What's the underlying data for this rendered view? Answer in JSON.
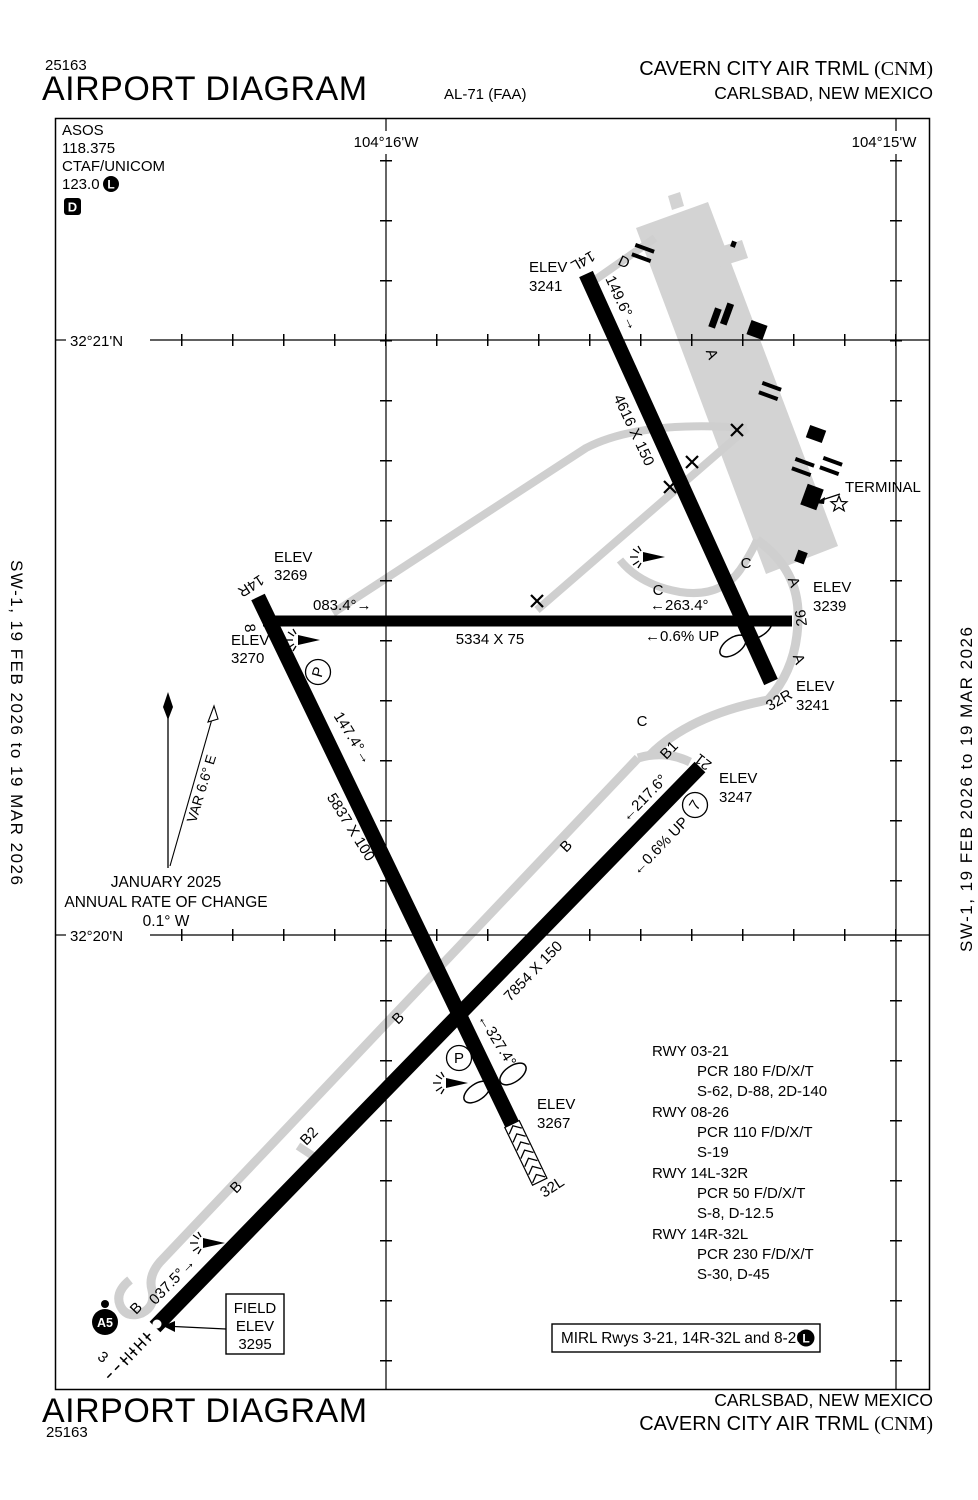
{
  "header": {
    "chart_number": "25163",
    "title": "AIRPORT DIAGRAM",
    "plate_id": "AL-71 (FAA)",
    "airport_name": "CAVERN CITY AIR TRML",
    "airport_code": "(CNM)",
    "city": "CARLSBAD, NEW MEXICO"
  },
  "footer": {
    "chart_number": "25163",
    "title": "AIRPORT DIAGRAM",
    "airport_name": "CAVERN CITY AIR TRML",
    "airport_code": "(CNM)",
    "city": "CARLSBAD, NEW MEXICO"
  },
  "margin_note": "SW-1,  19 FEB 2026  to  19 MAR 2026",
  "comm": {
    "asos_label": "ASOS",
    "asos_freq": "118.375",
    "ctaf_label": "CTAF/UNICOM",
    "ctaf_freq": "123.0",
    "lighting_badge": "L",
    "weather_badge": "D"
  },
  "grid": {
    "lon_west": "104°16'W",
    "lon_east": "104°15'W",
    "lat_north": "32°21'N",
    "lat_south": "32°20'N"
  },
  "magnetic": {
    "month": "JANUARY 2025",
    "note": "ANNUAL RATE OF CHANGE",
    "rate": "0.1° W",
    "variation": "VAR 6.6° E"
  },
  "terminal_label": "TERMINAL",
  "field_elevation": {
    "line1": "FIELD",
    "line2": "ELEV",
    "line3": "3295"
  },
  "mirl": {
    "text": "MIRL Rwys 3-21, 14R-32L and 8-26",
    "badge": "L"
  },
  "rwy_data": [
    {
      "rwy": "RWY 03-21",
      "pcr": "PCR 180 F/D/X/T",
      "strength": "S-62, D-88, 2D-140"
    },
    {
      "rwy": "RWY 08-26",
      "pcr": "PCR 110 F/D/X/T",
      "strength": "S-19"
    },
    {
      "rwy": "RWY 14L-32R",
      "pcr": "PCR 50 F/D/X/T",
      "strength": "S-8, D-12.5"
    },
    {
      "rwy": "RWY 14R-32L",
      "pcr": "PCR 230 F/D/X/T",
      "strength": "S-30, D-45"
    }
  ],
  "runways": {
    "r14l": {
      "end": "14L",
      "elev_label": "ELEV",
      "elev": "3241",
      "heading": "149.6°→",
      "dims": "4616 X 150"
    },
    "r32r": {
      "end": "32R",
      "elev_label": "ELEV",
      "elev": "3241"
    },
    "r8": {
      "end": "8",
      "elev_label": "ELEV",
      "elev": "3270",
      "heading": "083.4°→",
      "dims": "5334 X 75"
    },
    "r26": {
      "end": "26",
      "elev_label": "ELEV",
      "elev": "3239",
      "heading": "←263.4°",
      "slope": "←0.6% UP"
    },
    "r14r": {
      "end": "14R",
      "elev_label": "ELEV",
      "elev": "3269",
      "heading": "147.4°→",
      "dims": "5837 X 100"
    },
    "r32l": {
      "end": "32L",
      "elev_label": "ELEV",
      "elev": "3267",
      "heading": "←327.4°"
    },
    "r3": {
      "end": "3",
      "heading": "037.5°→"
    },
    "r21": {
      "end": "21",
      "elev_label": "ELEV",
      "elev": "3247",
      "heading": "←217.6°",
      "slope": "←0.6% UP",
      "dims": "7854 X 150"
    }
  },
  "taxiways": {
    "a": "A",
    "b": "B",
    "b1": "B1",
    "b2": "B2",
    "c": "C",
    "d": "D",
    "p": "P",
    "spot7": "7",
    "a5": "A5"
  },
  "colors": {
    "ink": "#000000",
    "taxiway_gray": "#cfcfcf",
    "paper": "#ffffff"
  }
}
